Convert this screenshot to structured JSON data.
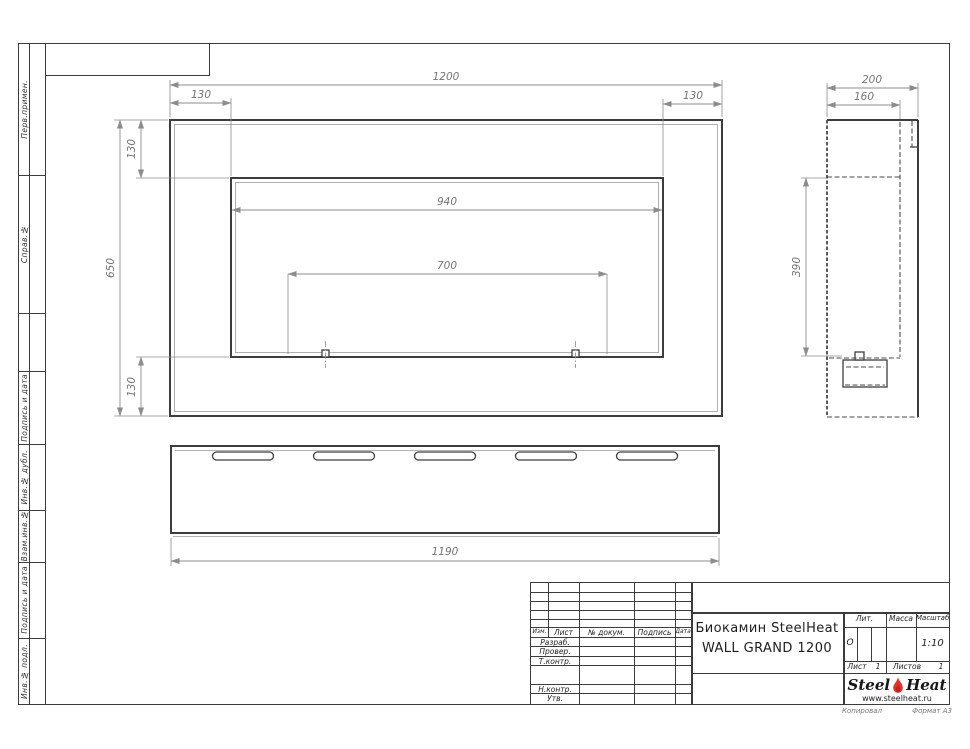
{
  "sheet": {
    "margin_labels": [
      "Перв.примен.",
      "Справ.№",
      "Подпись и дата",
      "Инв.№ дубл.",
      "Взам.инв.№",
      "Подпись и дата",
      "Инв.№ подл."
    ],
    "kopiroval": "Копировал",
    "format": "Формат А3"
  },
  "dimensions": {
    "front": {
      "overall_width": "1200",
      "left_offset": "130",
      "right_offset": "130",
      "opening_width": "940",
      "lower_span": "700",
      "overall_height": "650",
      "top_offset": "130",
      "bottom_offset": "130"
    },
    "side": {
      "overall_depth": "200",
      "body_depth": "160",
      "opening_height": "390"
    },
    "bottom": {
      "overall_width": "1190"
    }
  },
  "title_block": {
    "product_line1": "Биокамин SteelHeat",
    "product_line2": "WALL GRAND 1200",
    "col_izm": "Изм.",
    "col_list": "Лист",
    "col_doc": "№ докум.",
    "col_sign": "Подпись",
    "col_date": "Дата",
    "row_razrab": "Разраб.",
    "row_prover": "Провер.",
    "row_tkontr": "Т.контр.",
    "row_nkontr": "Н.контр.",
    "row_utv": "Утв.",
    "lit_label": "Лит.",
    "lit_value": "О",
    "mass_label": "Масса",
    "scale_label": "Масштаб",
    "scale_value": "1:10",
    "sheet_label": "Лист",
    "sheet_value": "1",
    "sheets_label": "Листов",
    "sheets_value": "1",
    "logo_steel": "Steel",
    "logo_heat": "Heat",
    "logo_site": "www.steelheat.ru",
    "flame_color": "#e5332a"
  }
}
